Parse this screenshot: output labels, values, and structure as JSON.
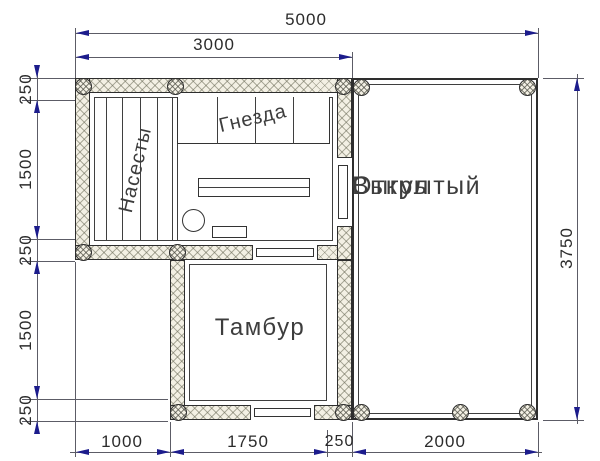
{
  "rooms": {
    "open_run": {
      "line1": "Открытый",
      "line2": "Выгул"
    },
    "vestibule": "Тамбур",
    "nests": "Гнезда",
    "perches": "Насесты"
  },
  "dimensions": {
    "overall_width_mm": "5000",
    "coop_width_mm": "3000",
    "overall_depth_mm": "3750",
    "left_chain": [
      "250",
      "1500",
      "250",
      "1500",
      "250"
    ],
    "bottom_chain": [
      "1000",
      "1750",
      "250",
      "2000"
    ]
  },
  "colors": {
    "arrow": "#1c1c8c",
    "dim_line": "#5c5c66",
    "wall_outline": "#2e2e2e",
    "wall_fill": "#f3f0e4",
    "label_text": "#3d3d3d",
    "dim_text": "#2b2b2b",
    "background": "#ffffff"
  }
}
